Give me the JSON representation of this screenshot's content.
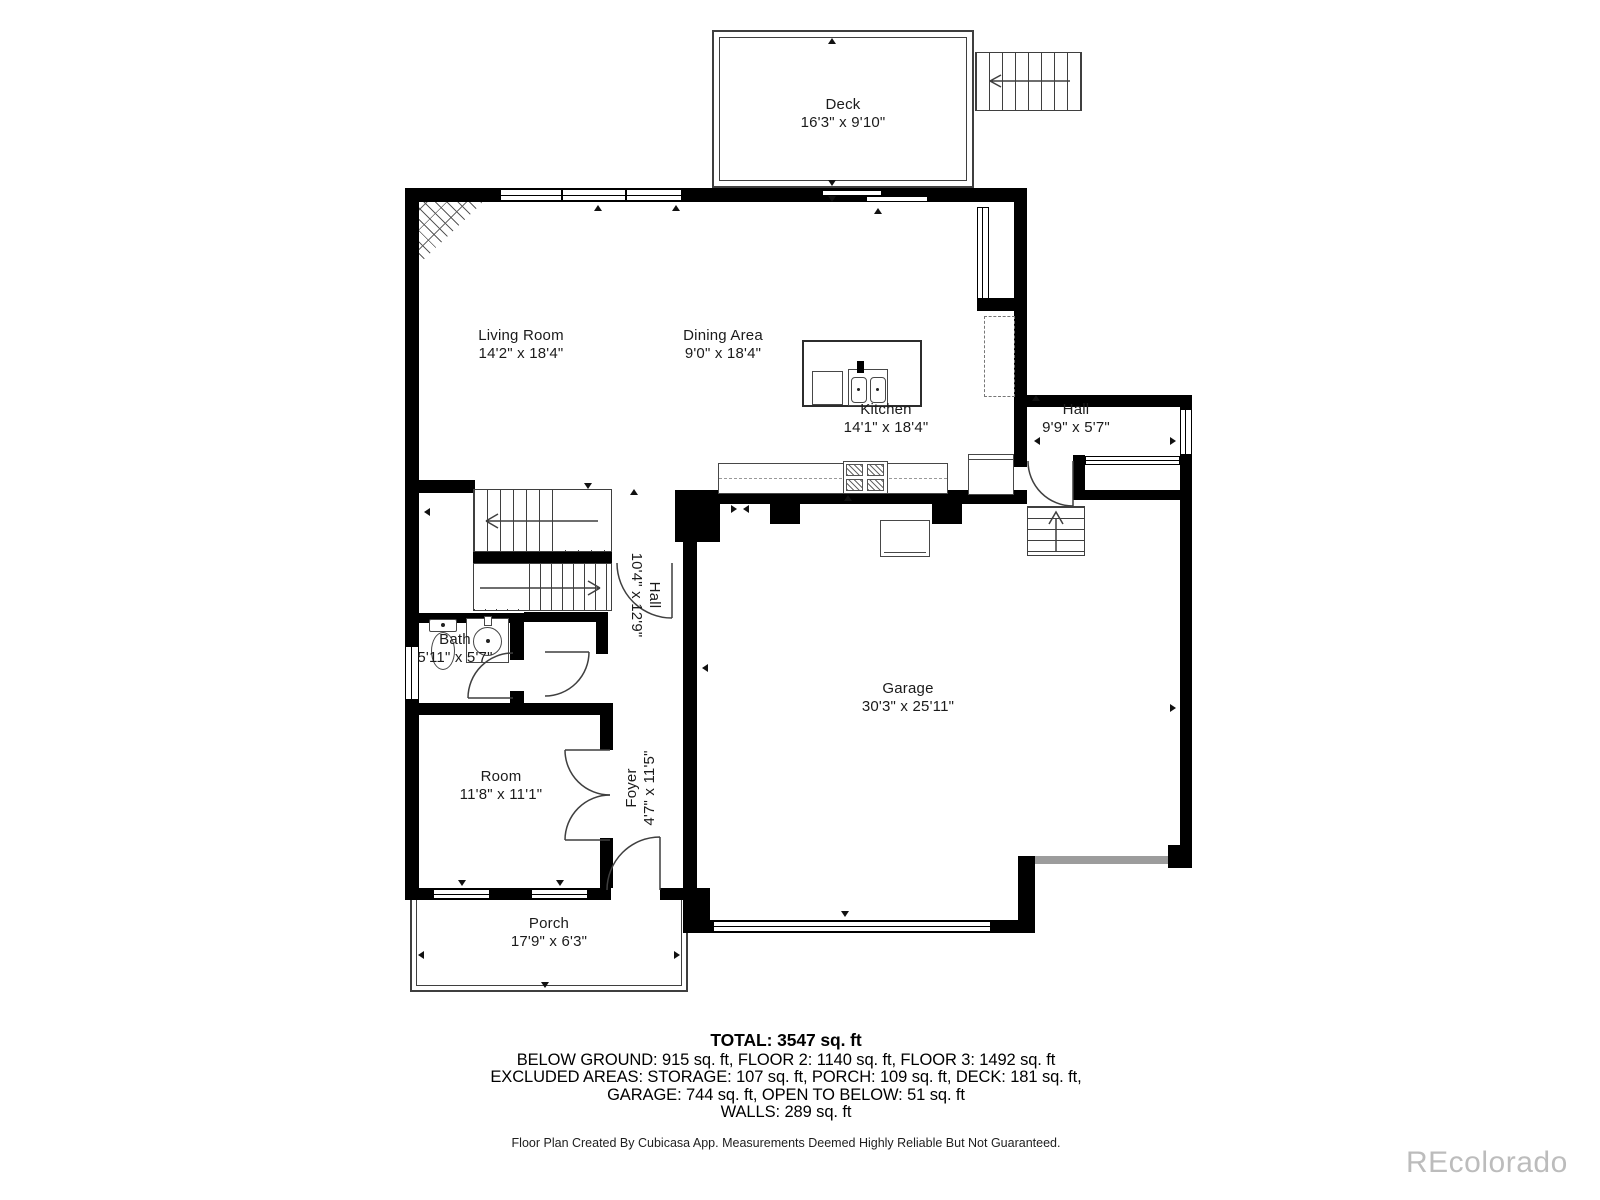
{
  "plan": {
    "rooms": [
      {
        "name": "Deck",
        "dims": "16'3\" x 9'10\""
      },
      {
        "name": "Living Room",
        "dims": "14'2\" x 18'4\""
      },
      {
        "name": "Dining Area",
        "dims": "9'0\" x 18'4\""
      },
      {
        "name": "Kitchen",
        "dims": "14'1\" x 18'4\""
      },
      {
        "name": "Hall",
        "dims": "9'9\" x 5'7\""
      },
      {
        "name": "Hall",
        "dims": "10'4\" x 12'9\""
      },
      {
        "name": "Bath",
        "dims": "5'11\" x 5'7\""
      },
      {
        "name": "Room",
        "dims": "11'8\" x 11'1\""
      },
      {
        "name": "Foyer",
        "dims": "4'7\" x 11'5\""
      },
      {
        "name": "Garage",
        "dims": "30'3\" x 25'11\""
      },
      {
        "name": "Porch",
        "dims": "17'9\" x 6'3\""
      }
    ],
    "summary": {
      "total": "TOTAL: 3547 sq. ft",
      "line2": "BELOW GROUND: 915 sq. ft, FLOOR 2: 1140 sq. ft, FLOOR 3: 1492 sq. ft",
      "line3": "EXCLUDED AREAS: STORAGE: 107 sq. ft, PORCH: 109 sq. ft, DECK: 181 sq. ft,",
      "line4": "GARAGE: 744 sq. ft, OPEN TO BELOW: 51 sq. ft",
      "line5": "WALLS: 289 sq. ft"
    },
    "footer": "Floor Plan Created By Cubicasa App. Measurements Deemed Highly Reliable But Not Guaranteed.",
    "watermark": "REcolorado",
    "colors": {
      "wall": "#000000",
      "thin_line": "#3f3f3f",
      "door_band": "#9c9c9c",
      "watermark": "#bcbcbc"
    }
  }
}
